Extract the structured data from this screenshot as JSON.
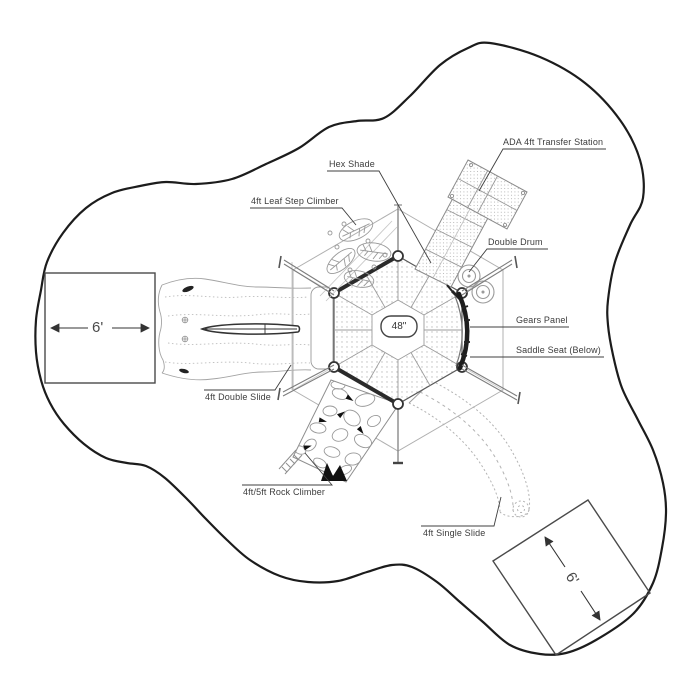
{
  "callouts": {
    "ada_transfer_station": "ADA 4ft Transfer Station",
    "hex_shade": "Hex Shade",
    "leaf_step_climber": "4ft Leaf Step Climber",
    "double_drum": "Double Drum",
    "gears_panel": "Gears Panel",
    "saddle_seat": "Saddle Seat (Below)",
    "double_slide": "4ft Double Slide",
    "rock_climber": "4ft/5ft Rock Climber",
    "single_slide": "4ft Single Slide"
  },
  "dimensions": {
    "deck_diameter": "48\"",
    "left_clearance": "6'",
    "right_clearance": "6'"
  },
  "colors": {
    "border_ink": "#1c1c1c",
    "label_ink": "#3c3c3c",
    "light_line": "#9a9a9a",
    "background": "#ffffff"
  }
}
